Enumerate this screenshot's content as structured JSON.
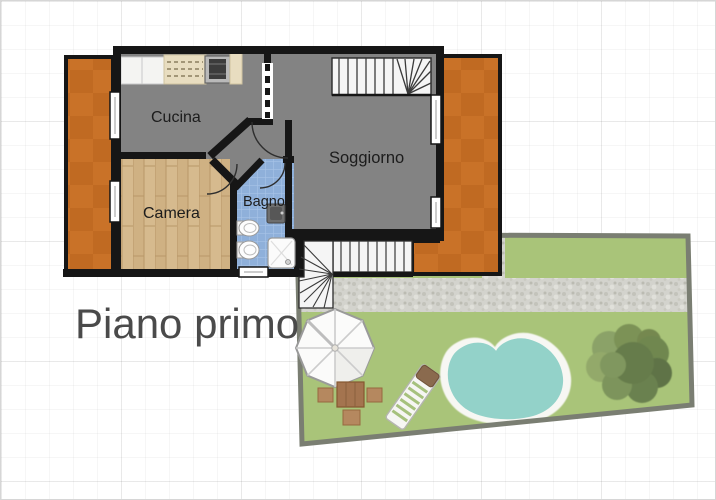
{
  "floor_plan": {
    "floor_label": "Piano primo",
    "rooms": [
      {
        "name": "Cucina"
      },
      {
        "name": "Camera"
      },
      {
        "name": "Bagno"
      },
      {
        "name": "Soggiorno"
      }
    ],
    "outdoor_features": [
      "garden",
      "pool",
      "tree",
      "gazebo",
      "garden-table-and-chairs",
      "sun-lounger",
      "gravel-path",
      "external-staircase",
      "balcony-left",
      "terrace-right"
    ],
    "colors": {
      "wall": "#161616",
      "floor_gray": "#838383",
      "bedroom_wood": "#d6ba8e",
      "bathroom_blue": "#8fb0da",
      "balcony_orange": "#c97228",
      "lawn_green": "#a9c479",
      "gravel_gray": "#d3d3cd",
      "pool_water": "#93d2c9",
      "pool_deck": "#f7f7f3",
      "title_text": "#4a4a4a"
    }
  }
}
